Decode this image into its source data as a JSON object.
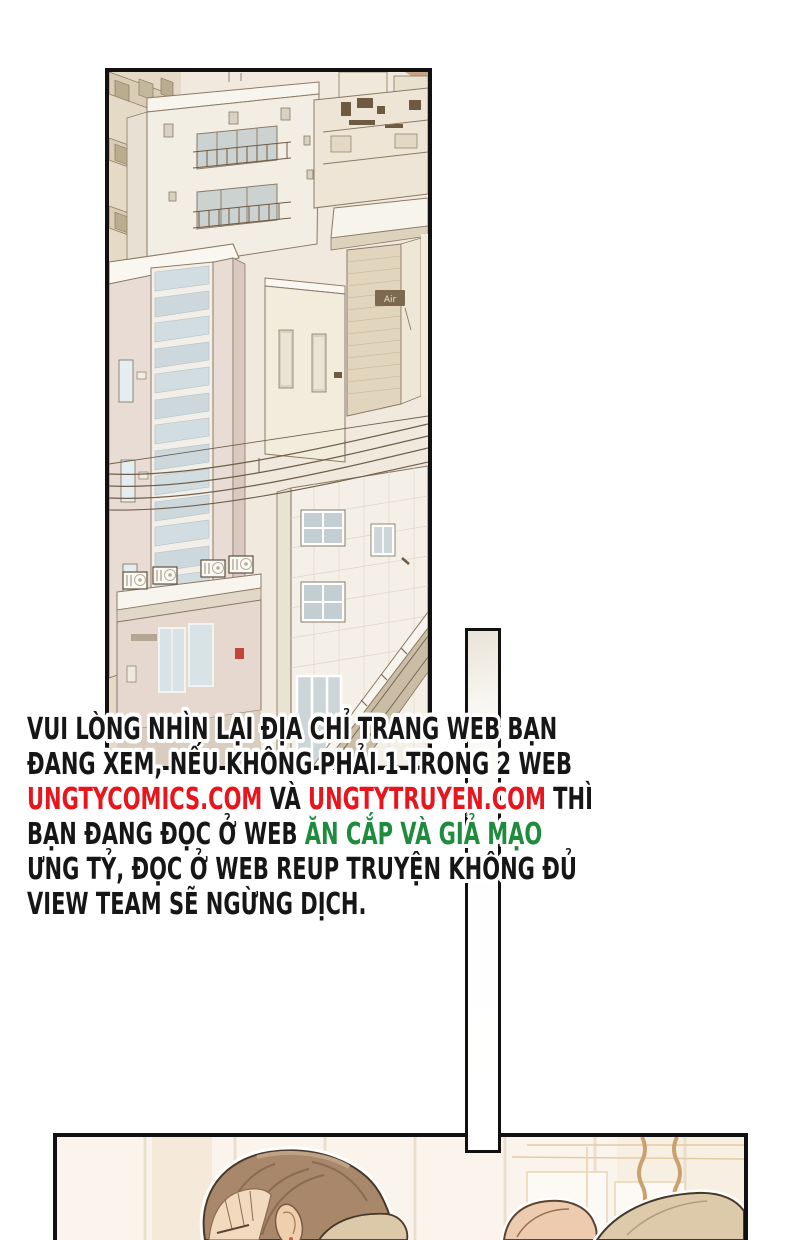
{
  "page": {
    "background": "#ffffff",
    "width": 793,
    "height": 1240
  },
  "colors": {
    "text_black": "#161616",
    "url_red": "#e8151c",
    "highlight_green": "#1e8c3c",
    "panel_border": "#111111"
  },
  "warning": {
    "lines": [
      [
        {
          "t": "VUI LÒNG NHÌN LẠI ĐỊA CHỈ TRANG WEB BẠN",
          "c": "black"
        }
      ],
      [
        {
          "t": "ĐANG XEM, NẾU KHÔNG PHẢI 1 TRONG 2 WEB",
          "c": "black"
        }
      ],
      [
        {
          "t": "UNGTYCOMICS.COM",
          "c": "red"
        },
        {
          "t": " VÀ ",
          "c": "black"
        },
        {
          "t": "UNGTYTRUYEN.COM",
          "c": "red"
        },
        {
          "t": " THÌ",
          "c": "black"
        }
      ],
      [
        {
          "t": "BẠN ĐANG ĐỌC Ở WEB ",
          "c": "black"
        },
        {
          "t": "ĂN CẮP VÀ GIẢ MẠO",
          "c": "green"
        }
      ],
      [
        {
          "t": "ƯNG TỶ, ĐỌC Ở WEB REUP TRUYỆN KHÔNG ĐỦ",
          "c": "black"
        }
      ],
      [
        {
          "t": "VIEW TEAM SẼ NGỪNG DỊCH.",
          "c": "black"
        }
      ]
    ]
  },
  "panels": {
    "city": {
      "label": "city skyline illustration",
      "sign_text": "Air"
    },
    "scene": {
      "label": "character interior scene"
    }
  }
}
